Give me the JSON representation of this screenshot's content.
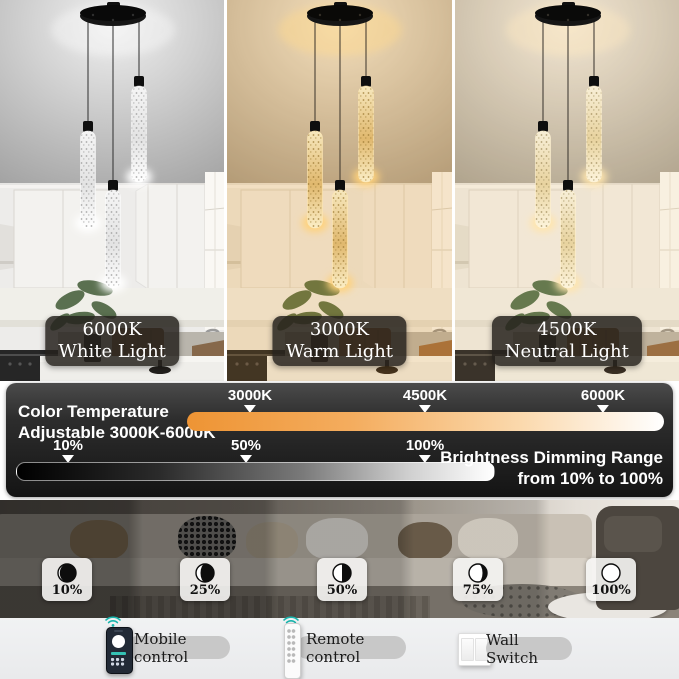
{
  "panels": [
    {
      "temp": "6000K",
      "mode": "White Light"
    },
    {
      "temp": "3000K",
      "mode": "Warm Light"
    },
    {
      "temp": "4500K",
      "mode": "Neutral Light"
    }
  ],
  "banner": {
    "title_line1": "Color Temperature",
    "title_line2": "Adjustable 3000K-6000K",
    "temp_scale": {
      "ticks": [
        "3000K",
        "4500K",
        "6000K"
      ],
      "gradient": [
        "#ee9434",
        "#ffffff"
      ]
    },
    "dim_scale": {
      "ticks": [
        "10%",
        "50%",
        "100%"
      ],
      "gradient": [
        "#000000",
        "#ffffff"
      ]
    },
    "dim_caption_line1": "Brightness Dimming Range",
    "dim_caption_line2": "from 10% to 100%"
  },
  "brightness_levels": [
    {
      "label": "10%",
      "fraction": 0.1
    },
    {
      "label": "25%",
      "fraction": 0.25
    },
    {
      "label": "50%",
      "fraction": 0.5
    },
    {
      "label": "75%",
      "fraction": 0.75
    },
    {
      "label": "100%",
      "fraction": 1.0
    }
  ],
  "controls": [
    {
      "label": "Mobile control",
      "icon": "smartphone-icon"
    },
    {
      "label": "Remote control",
      "icon": "remote-icon"
    },
    {
      "label": "Wall Switch",
      "icon": "wall-switch-icon"
    }
  ],
  "colors": {
    "accent_orange": "#f09c4a",
    "wifi_teal": "#1ab5ad",
    "banner_bg": "#1c1c1c"
  }
}
